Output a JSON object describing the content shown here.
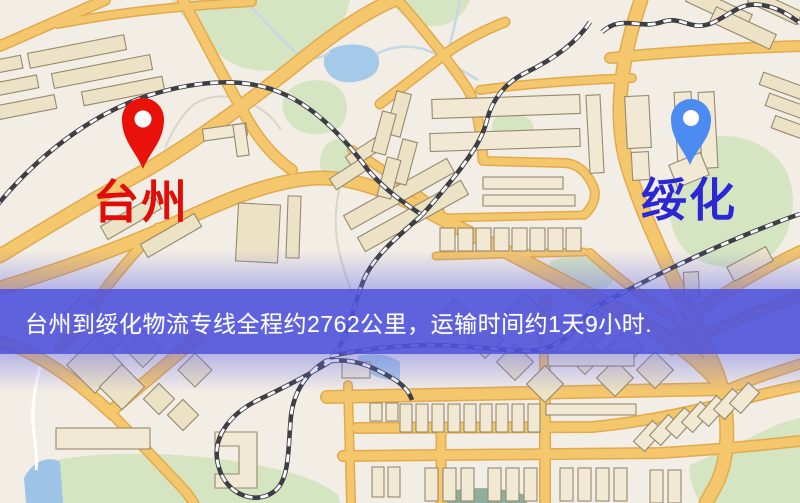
{
  "map": {
    "origin": {
      "name": "台州",
      "marker_icon": "map-pin-icon",
      "marker_color": "#e8120a",
      "label_color": "#e20d06"
    },
    "destination": {
      "name": "绥化",
      "marker_icon": "map-pin-icon",
      "marker_color": "#4c8bf2",
      "label_color": "#2a27d4"
    }
  },
  "banner": {
    "text": "台州到绥化物流专线全程约2762公里，运输时间约1天9小时.",
    "distance_km": "2762",
    "transit_time": "1天9小时",
    "background_color": "#4d51db",
    "text_color": "#ffffff"
  }
}
